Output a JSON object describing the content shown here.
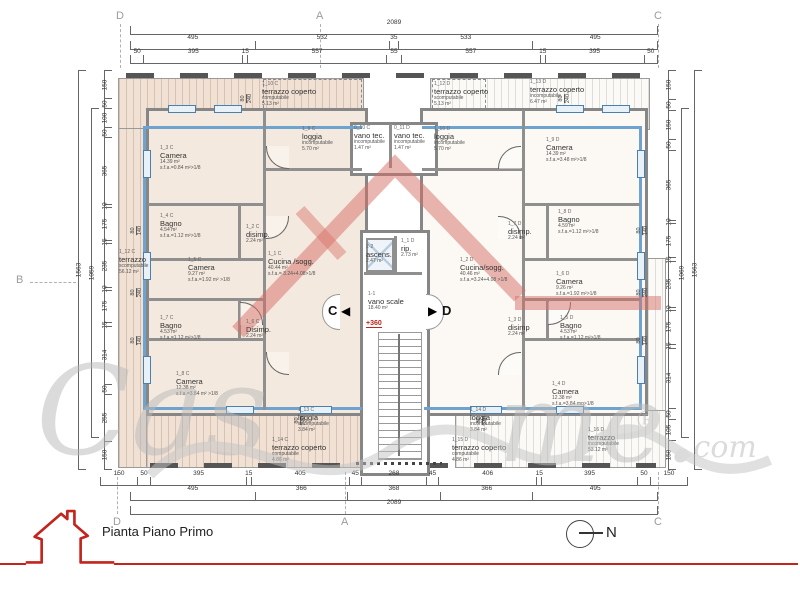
{
  "title": {
    "label": "Pianta Piano Primo",
    "north": "N"
  },
  "watermark": {
    "w1": "Cas",
    "w2": "me.",
    "reg": "®",
    "w3": ".com"
  },
  "sections": {
    "left": "C",
    "right": "D"
  },
  "level_marker": "+360",
  "axes": [
    {
      "l": "D",
      "x": 116,
      "y": 10,
      "d": "down"
    },
    {
      "l": "A",
      "x": 316,
      "y": 10,
      "d": "down"
    },
    {
      "l": "C",
      "x": 654,
      "y": 10,
      "d": "down"
    },
    {
      "l": "D",
      "x": 113,
      "y": 516,
      "d": "up"
    },
    {
      "l": "A",
      "x": 341,
      "y": 516,
      "d": "up"
    },
    {
      "l": "C",
      "x": 654,
      "y": 516,
      "d": "up"
    },
    {
      "l": "B",
      "x": 16,
      "y": 274,
      "d": "right"
    }
  ],
  "dims": {
    "rows": [
      {
        "n": "top-total",
        "o": "h",
        "x": 130,
        "y": 26,
        "len": 528,
        "vals": [
          "2089"
        ]
      },
      {
        "n": "top-mid",
        "o": "h",
        "x": 130,
        "y": 41,
        "len": 528,
        "vals": [
          "495",
          "532",
          "35",
          "533",
          "495"
        ]
      },
      {
        "n": "top-detail",
        "o": "h",
        "x": 130,
        "y": 55,
        "len": 528,
        "vals": [
          "50",
          "395",
          "15",
          "557",
          "55",
          "557",
          "15",
          "395",
          "50"
        ]
      },
      {
        "n": "bottom-detail",
        "o": "h",
        "x": 100,
        "y": 477,
        "len": 588,
        "vals": [
          "150",
          "50",
          "395",
          "15",
          "405",
          "45",
          "268",
          "45",
          "406",
          "15",
          "395",
          "50",
          "150"
        ]
      },
      {
        "n": "bottom-mid",
        "o": "h",
        "x": 130,
        "y": 492,
        "len": 528,
        "vals": [
          "495",
          "366",
          "368",
          "366",
          "495"
        ]
      },
      {
        "n": "bottom-total",
        "o": "h",
        "x": 130,
        "y": 506,
        "len": 528,
        "vals": [
          "2089"
        ]
      },
      {
        "n": "left-col",
        "o": "v",
        "x": 104,
        "y": 70,
        "len": 400,
        "vals": [
          "150",
          "50",
          "100",
          "50",
          "365",
          "10",
          "175",
          "15",
          "235",
          "10",
          "175",
          "15",
          "314",
          "50",
          "255",
          "150"
        ]
      },
      {
        "n": "left-sub",
        "o": "v",
        "x": 91,
        "y": 108,
        "len": 330,
        "vals": [
          "1059"
        ]
      },
      {
        "n": "left-total",
        "o": "v",
        "x": 78,
        "y": 70,
        "len": 400,
        "vals": [
          "1563"
        ]
      },
      {
        "n": "right-col",
        "o": "v",
        "x": 668,
        "y": 70,
        "len": 400,
        "vals": [
          "150",
          "50",
          "150",
          "50",
          "365",
          "10",
          "175",
          "15",
          "235",
          "10",
          "175",
          "15",
          "314",
          "50",
          "105",
          "150"
        ]
      },
      {
        "n": "right-sub",
        "o": "v",
        "x": 681,
        "y": 108,
        "len": 330,
        "vals": [
          "1069"
        ]
      },
      {
        "n": "right-total",
        "o": "v",
        "x": 694,
        "y": 70,
        "len": 400,
        "vals": [
          "1563"
        ]
      }
    ]
  },
  "win_dims": [
    {
      "x": 132,
      "y": 224,
      "a": "80",
      "b": "140"
    },
    {
      "x": 132,
      "y": 286,
      "a": "80",
      "b": "240"
    },
    {
      "x": 132,
      "y": 334,
      "a": "80",
      "b": "140"
    },
    {
      "x": 638,
      "y": 224,
      "a": "80",
      "b": "140"
    },
    {
      "x": 638,
      "y": 286,
      "a": "80",
      "b": "240"
    },
    {
      "x": 638,
      "y": 334,
      "a": "80",
      "b": "140"
    },
    {
      "x": 242,
      "y": 92,
      "a": "80",
      "b": "240"
    },
    {
      "x": 560,
      "y": 92,
      "a": "80",
      "b": "240"
    },
    {
      "x": 296,
      "y": 414,
      "a": "80",
      "b": "240"
    },
    {
      "x": 478,
      "y": 414,
      "a": "80",
      "b": "240"
    }
  ],
  "rooms": [
    {
      "n": "terrazzo-coperto-1-10c",
      "x": 262,
      "y": 82,
      "w": 92,
      "id": "1_10 C",
      "name": "terrazzo coperto",
      "l1": "computabile",
      "l2": "5.13 m²"
    },
    {
      "n": "loggia-1-9c",
      "x": 302,
      "y": 127,
      "w": 58,
      "id": "1_9 C",
      "name": "loggia",
      "l1": "incomputabile",
      "l2": "5.70 m²"
    },
    {
      "n": "vano-tec-0-10c",
      "x": 354,
      "y": 126,
      "w": 36,
      "id": "0_10 C",
      "name": "vano tec.",
      "l1": "incomputabile",
      "l2": "1.47 m²"
    },
    {
      "n": "vano-tec-0-11d",
      "x": 394,
      "y": 126,
      "w": 36,
      "id": "0_11 D",
      "name": "vano tec.",
      "l1": "incomputabile",
      "l2": "1.47 m²"
    },
    {
      "n": "loggia-1-10d",
      "x": 434,
      "y": 127,
      "w": 58,
      "id": "1_10 D",
      "name": "loggia",
      "l1": "incomputabile",
      "l2": "5.70 m²"
    },
    {
      "n": "terrazzo-coperto-1-12d",
      "x": 434,
      "y": 82,
      "w": 92,
      "id": "1_12 D",
      "name": "terrazzo coperto",
      "l1": "scomputabile",
      "l2": "5.13 m²"
    },
    {
      "n": "terrazzo-coperto-1-13d",
      "x": 530,
      "y": 80,
      "w": 92,
      "id": "1_13 D",
      "name": "terrazzo coperto",
      "l1": "incomputabile",
      "l2": "6.47 m²"
    },
    {
      "n": "camera-1-3c",
      "x": 160,
      "y": 146,
      "w": 92,
      "id": "1_3 C",
      "name": "Camera",
      "l1": "14.39 m²",
      "l2": "s.f.a.=0.84 m²>1/8"
    },
    {
      "n": "camera-1-9d",
      "x": 546,
      "y": 138,
      "w": 92,
      "id": "1_9 D",
      "name": "Camera",
      "l1": "14.39 m²",
      "l2": "s.f.a.=3.48 m²>1/8"
    },
    {
      "n": "bagno-1-4c",
      "x": 160,
      "y": 214,
      "w": 80,
      "id": "1_4 C",
      "name": "Bagno",
      "l1": "4.54 m²",
      "l2": "s.f.a.=1.12 m²>1/8"
    },
    {
      "n": "disimp-1-2c",
      "x": 246,
      "y": 225,
      "w": 46,
      "id": "1_2 C",
      "name": "disimp.",
      "l1": "2.24 m²"
    },
    {
      "n": "bagno-1-8d",
      "x": 558,
      "y": 210,
      "w": 80,
      "id": "1_8 D",
      "name": "Bagno",
      "l1": "4.59 m²",
      "l2": "s.f.a.=1.12 m²>1/8"
    },
    {
      "n": "disimp-1-7d",
      "x": 508,
      "y": 222,
      "w": 46,
      "id": "1_7 D",
      "name": "disimp.",
      "l1": "2.24 m²"
    },
    {
      "n": "terrazzo-1-12c",
      "x": 119,
      "y": 250,
      "w": 46,
      "id": "1_12 C",
      "name": "terrazzo",
      "l1": "scomputabile",
      "l2": "56.12 m²"
    },
    {
      "n": "camera-1-5c",
      "x": 188,
      "y": 258,
      "w": 76,
      "id": "1_5 C",
      "name": "Camera",
      "l1": "9.27 m²",
      "l2": "s.f.a.=1.92 m² >1/8"
    },
    {
      "n": "cucina-sogg-1-1c",
      "x": 268,
      "y": 252,
      "w": 92,
      "id": "1_1 C",
      "name": "Cucina /sogg.",
      "l1": "40.44 m²",
      "l2": "s.f.a.= 3.24+4.08>1/8"
    },
    {
      "n": "cucina-sogg-1-2d",
      "x": 460,
      "y": 258,
      "w": 92,
      "id": "1_2 D",
      "name": "Cucina/sogg.",
      "l1": "40.46 m²",
      "l2": "s.f.a.=3.24+4.08 >1/8"
    },
    {
      "n": "camera-1-6d",
      "x": 556,
      "y": 272,
      "w": 76,
      "id": "1_6 D",
      "name": "Camera",
      "l1": "9.26 m²",
      "l2": "s.f.a.=1.92 m²>1/8"
    },
    {
      "n": "bagno-1-7c",
      "x": 160,
      "y": 316,
      "w": 80,
      "id": "1_7 C",
      "name": "Bagno",
      "l1": "4.53 m²",
      "l2": "s.f.a.=1.12 m²>1/8"
    },
    {
      "n": "disimp-1-6c",
      "x": 246,
      "y": 320,
      "w": 46,
      "id": "1_6 C",
      "name": "Disimp.",
      "l1": "2.24 m²"
    },
    {
      "n": "bagno-1-5d",
      "x": 560,
      "y": 316,
      "w": 80,
      "id": "1_5 D",
      "name": "Bagno",
      "l1": "4.53 m²",
      "l2": "s.f.a.=1.12 m²>1/8"
    },
    {
      "n": "disimp-1-3d",
      "x": 508,
      "y": 318,
      "w": 46,
      "id": "1_3 D",
      "name": "disimp",
      "l1": "2.24 m²"
    },
    {
      "n": "camera-1-8c",
      "x": 176,
      "y": 372,
      "w": 92,
      "id": "1_8 C",
      "name": "Camera",
      "l1": "12.38 m²",
      "l2": "s.f.a.=3.84 m² >1/8"
    },
    {
      "n": "camera-1-4d",
      "x": 552,
      "y": 382,
      "w": 92,
      "id": "1_4 D",
      "name": "Camera",
      "l1": "12.38 m²",
      "l2": "s.f.a.=3.84 mq>1/8"
    },
    {
      "n": "ascensore",
      "x": 366,
      "y": 245,
      "w": 38,
      "id": "2-2",
      "name": "ascens.",
      "l1": "2.47 m²"
    },
    {
      "n": "ripostiglio",
      "x": 401,
      "y": 239,
      "w": 32,
      "id": "1_1 D",
      "name": "rip.",
      "l1": "2.73 m²"
    },
    {
      "n": "vano-scale",
      "x": 368,
      "y": 292,
      "w": 52,
      "id": "1-1",
      "name": "vano scale",
      "l1": "18.40 m²"
    },
    {
      "n": "loggia-1-13c",
      "x": 298,
      "y": 408,
      "w": 58,
      "id": "1_13 C",
      "name": "loggia",
      "l1": "incomputabile",
      "l2": "3.84 m²"
    },
    {
      "n": "terrazzo-coperto-1-14c",
      "x": 272,
      "y": 438,
      "w": 90,
      "id": "1_14 C",
      "name": "terrazzo coperto",
      "l1": "computabile",
      "l2": "4.86 m²"
    },
    {
      "n": "loggia-1-14d",
      "x": 470,
      "y": 408,
      "w": 58,
      "id": "1_14 D",
      "name": "loggia",
      "l1": "incomputabile",
      "l2": "3.84 m²"
    },
    {
      "n": "terrazzo-coperto-1-15d",
      "x": 452,
      "y": 438,
      "w": 90,
      "id": "1_15 D",
      "name": "terrazzo coperto",
      "l1": "computabile",
      "l2": "4.86 m²"
    },
    {
      "n": "terrazzo-1-16d",
      "x": 588,
      "y": 428,
      "w": 60,
      "id": "1_16 D",
      "name": "terrazzo",
      "l1": "incomputabile",
      "l2": "53.12 m²"
    }
  ]
}
